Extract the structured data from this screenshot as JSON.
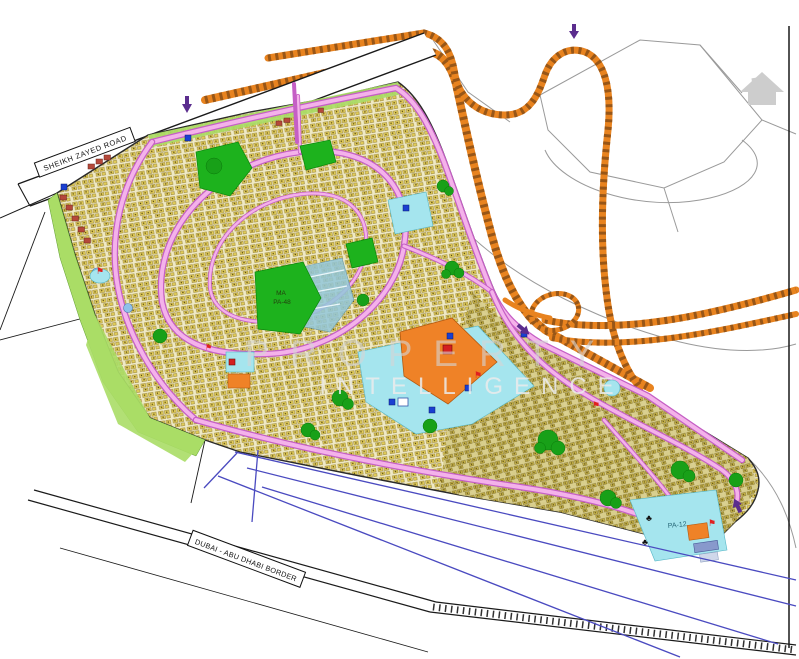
{
  "map": {
    "type": "master-plan-site-map",
    "roads": {
      "sheikh_zayed": "SHEIKH ZAYED ROAD",
      "border": "DUBAI - ABU DHABI BORDER"
    },
    "labels": {
      "central_park_line1": "MA",
      "central_park_line2": "PA-48",
      "tail_area": "PA-12"
    },
    "watermark": {
      "line1": "PROPERTY",
      "line2": "INTELLIGENCE"
    },
    "icons": {
      "tree": "♣",
      "flag": "⚑",
      "house": "⌂",
      "mosque": "▪",
      "arrow": "▼"
    },
    "palette": {
      "background": "#ffffff",
      "plot_yellow": "#e2cd58",
      "plot_outline": "#94803a",
      "road_pink": "#f4b2ea",
      "road_casing": "#c55fc5",
      "highway_orange": "#e8831f",
      "highway_hatch": "#8a4f16",
      "park_green": "#1db21d",
      "buffer_green": "#aadd66",
      "water_cyan": "#a5e5ee",
      "school_orange": "#ef8227",
      "red_plots": "#b5483a",
      "border_blue": "#4a4ac0",
      "parcel_gray": "#9a9a9a",
      "outline_black": "#1a1a1a",
      "arrow_purple": "#5b2d8e"
    }
  }
}
